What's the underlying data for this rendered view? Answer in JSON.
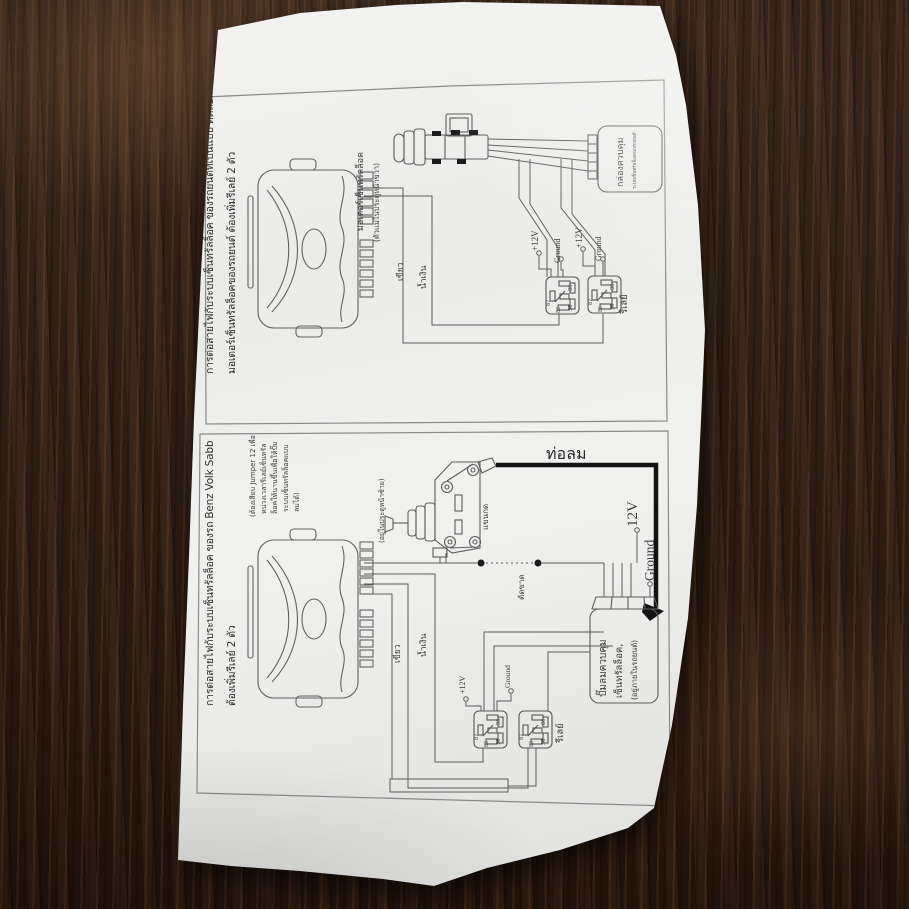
{
  "panel1": {
    "title_line1": "การต่อสายไฟกับระบบเซ็นทรัลล็อค ของรถยนต์ที่เป็นแบบ ดีดล็อค",
    "title_line2": "มอเตอร์เซ็นทรัลล็อคของรถยนต์ ต้องเพิ่มรีเลย์ 2 ตัว",
    "motor_label_line1": "มอเตอร์เซ็นทรัลล็อค",
    "motor_label_line2": "(ตัวแม่ในประตูหน้าขวา)",
    "wire_green": "เขียว",
    "wire_blue": "น้ำเงิน",
    "plus12v": "+12V",
    "ground": "Ground",
    "relay_label": "รีเลย์",
    "control_box": "กล่องควบคุม",
    "control_box_sub": "ระบบเซ็นทรัลล็อคของรถยนต์"
  },
  "panel2": {
    "title_line1": "การต่อสายไฟกับระบบเซ็นทรัลล็อค ของรถ Benz Volk Sabb",
    "title_line2": "ต้องเพิ่มรีเลย์ 2 ตัว",
    "note_line1": "(ต้องเสียบ Jumper 12 เพื่อ",
    "note_line2": "หน่วงเวลารีเลย์เซ็นทรัล",
    "note_line3": "ล็อคให้นานขึ้นเพื่อให้ปั๊ม",
    "note_line4": "ระบบเซ็นทรัลล็อคแบบ",
    "note_line5": "ลมได้)",
    "door_label": "(อยู่ในประตูหน้าซ้าย)",
    "arm_label": "แขนกด",
    "air_hose_label": "ท่อลม",
    "cut_label": "ตัดขาด",
    "wire_green": "เขียว",
    "wire_blue": "น้ำเงิน",
    "plus12v": "+12V",
    "ground": "Ground",
    "v12_big": "12V",
    "ground_big": "Ground",
    "relay_label": "รีเลย์",
    "pump_line1": "ปั๊มลมควบคุม",
    "pump_line2": "เซ็นทรัลล็อค,",
    "pump_line3": "(อยู่ภายในรถยนต์)"
  },
  "relay_pins": {
    "p87": "87",
    "p85": "85",
    "p86": "86",
    "p30": "30"
  }
}
